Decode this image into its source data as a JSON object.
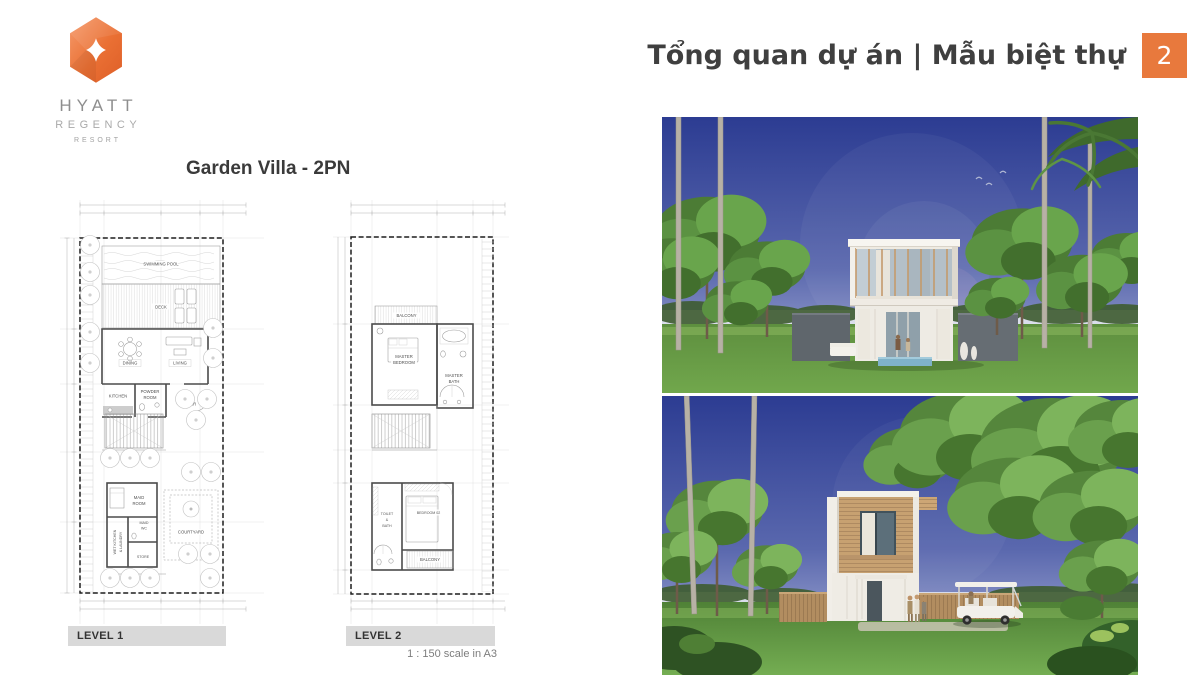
{
  "brand": {
    "logo_icon": "hyatt-diamond-icon",
    "name": "HYATT",
    "division": "REGENCY",
    "descriptor": "RESORT",
    "logo_color": "#E96F32"
  },
  "header": {
    "title": "Tổng quan dự án | Mẫu biệt thự",
    "page_number": "2",
    "accent_color": "#E8793D",
    "title_color": "#3F3F3F"
  },
  "floorplans": {
    "title": "Garden Villa - 2PN",
    "scale_note": "1 : 150 scale in A3",
    "level1": {
      "bar_label": "LEVEL 1",
      "rooms": {
        "swimming_pool": "SWIMMING POOL",
        "deck": "DECK",
        "dining": "DINING",
        "living": "LIVING",
        "kitchen": "KITCHEN",
        "powder_line1": "POWDER",
        "powder_line2": "ROOM",
        "foyer": "FOYER",
        "maid_line1": "MAID",
        "maid_line2": "ROOM",
        "wet_line1": "WET KITCHEN",
        "wet_line2": "& LAUNDRY",
        "maidwc_line1": "MAID",
        "maidwc_line2": "WC",
        "store": "STORE",
        "courtyard": "COURTYARD"
      }
    },
    "level2": {
      "bar_label": "LEVEL 2",
      "rooms": {
        "balcony_top": "BALCONY",
        "master_line1": "MASTER",
        "master_line2": "BEDROOM",
        "masterbath_line1": "MASTER",
        "masterbath_line2": "BATH",
        "toilet_line1": "TOILET",
        "toilet_line2": "&",
        "toilet_line3": "BATH",
        "bedroom2": "BEDROOM 02",
        "balcony_bottom": "BALCONY"
      }
    }
  }
}
